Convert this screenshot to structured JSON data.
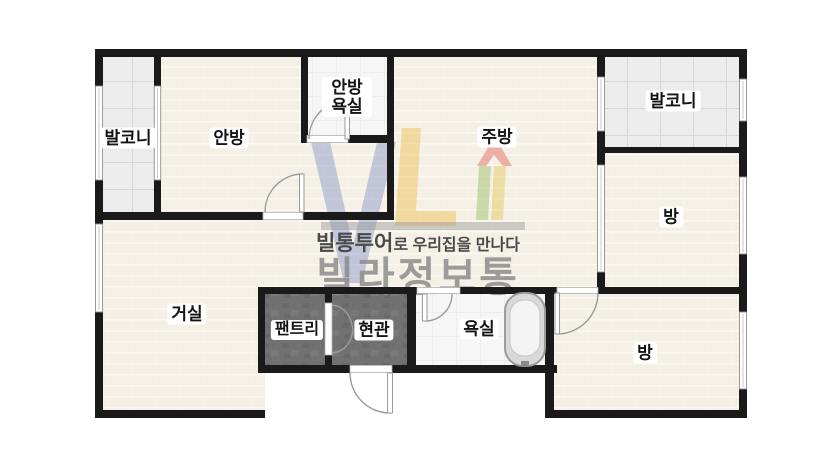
{
  "brand": {
    "tagline_bold": "빌통투어",
    "tagline_rest": "로 우리집을 만나다",
    "name": "빌라정보통"
  },
  "rooms": {
    "balcony_left": "발코니",
    "master_bedroom": "안방",
    "master_bath_line1": "안방",
    "master_bath_line2": "욕실",
    "kitchen": "주방",
    "balcony_right": "발코니",
    "room_top_right": "방",
    "living": "거실",
    "pantry": "팬트리",
    "entrance": "현관",
    "bath": "욕실",
    "room_bottom_right": "방"
  },
  "colors": {
    "wall": "#1a1a1a",
    "floor_cream": "#f5f0e6",
    "balcony_tile": "#ececec",
    "bath_floor": "#f6f6f6",
    "utility_dark": "#717171",
    "logo_blue": "#6272bd",
    "logo_yellow": "#ebb946",
    "logo_red": "#e16e64",
    "logo_green": "#96b95f",
    "brand_gray": "#8d8d8d"
  }
}
